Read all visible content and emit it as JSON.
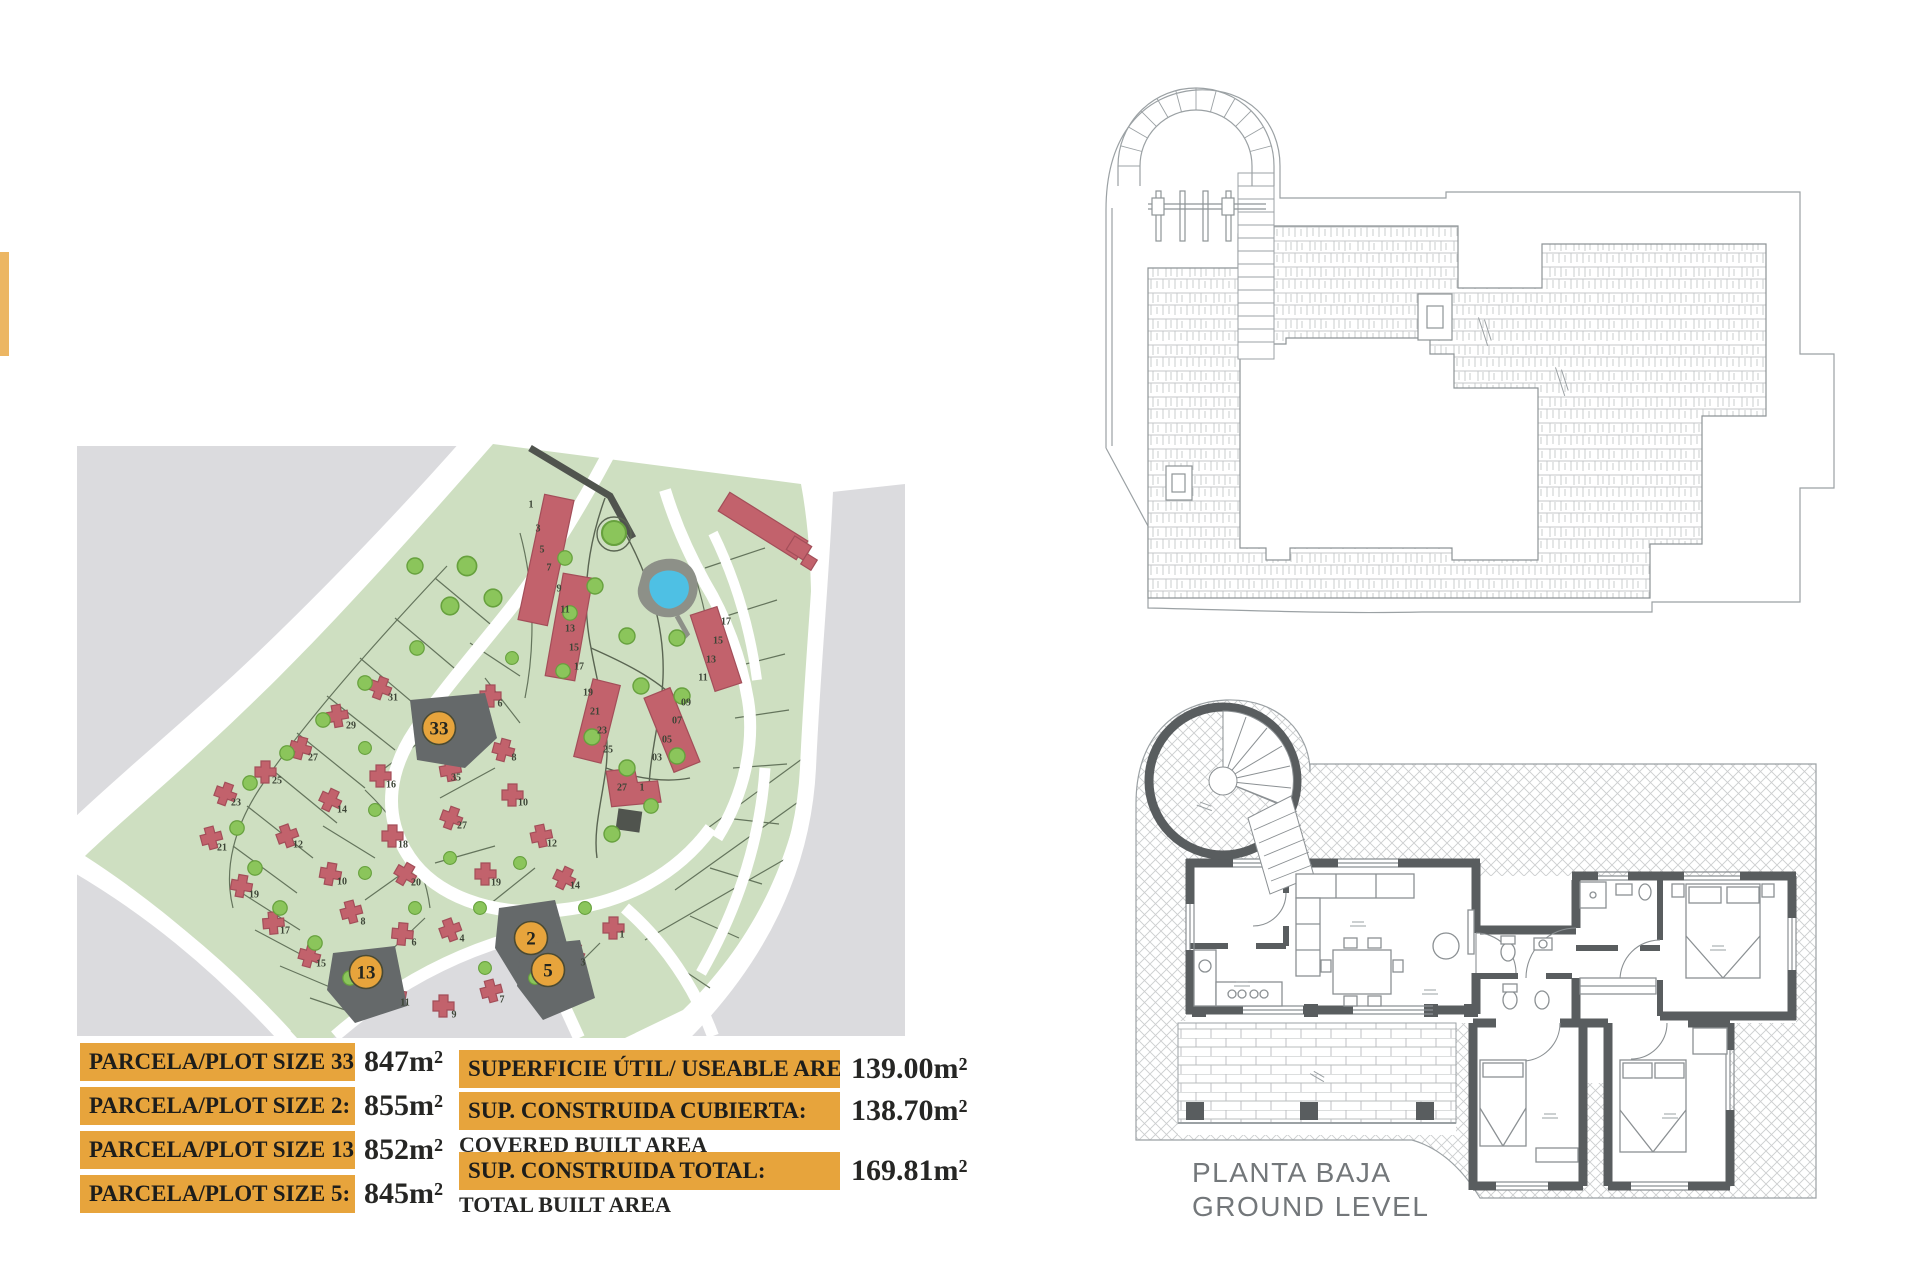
{
  "colors": {
    "accent_orange": "#e7a43c",
    "map_green": "#cedfc1",
    "map_gray": "#dbdbde",
    "building_red": "#c2626c",
    "tree_green": "#8bc55b",
    "pool_blue": "#4ec0e4",
    "highlight_plot_gray": "#65696a",
    "wall_gray": "#595d5f"
  },
  "plot_table": {
    "rows": [
      {
        "label": "PARCELA/PLOT SIZE 33:",
        "value": "847m²"
      },
      {
        "label": "PARCELA/PLOT SIZE 2:",
        "value": "855m²"
      },
      {
        "label": "PARCELA/PLOT SIZE 13:",
        "value": "852m²"
      },
      {
        "label": "PARCELA/PLOT SIZE 5:",
        "value": "845m²"
      }
    ]
  },
  "area_table": {
    "rows": [
      {
        "label": "SUPERFICIE ÚTIL/ USEABLE AREA:",
        "value": "139.00m²",
        "sublabel": ""
      },
      {
        "label": "SUP. CONSTRUIDA CUBIERTA:",
        "value": "138.70m²",
        "sublabel": "COVERED BUILT AREA"
      },
      {
        "label": "SUP. CONSTRUIDA TOTAL:",
        "value": "169.81m²",
        "sublabel": "TOTAL BUILT AREA"
      }
    ]
  },
  "ground_plan": {
    "title_line1": "PLANTA BAJA",
    "title_line2": "GROUND LEVEL"
  },
  "site_plan": {
    "highlights": [
      {
        "n": "33",
        "x": 374,
        "y": 290
      },
      {
        "n": "2",
        "x": 466,
        "y": 500
      },
      {
        "n": "13",
        "x": 301,
        "y": 534
      },
      {
        "n": "5",
        "x": 483,
        "y": 532
      }
    ],
    "plot_numbers": [
      {
        "n": "1",
        "x": 466,
        "y": 66
      },
      {
        "n": "3",
        "x": 473,
        "y": 90
      },
      {
        "n": "5",
        "x": 477,
        "y": 111
      },
      {
        "n": "7",
        "x": 484,
        "y": 129
      },
      {
        "n": "9",
        "x": 494,
        "y": 150
      },
      {
        "n": "11",
        "x": 500,
        "y": 171
      },
      {
        "n": "13",
        "x": 505,
        "y": 190
      },
      {
        "n": "15",
        "x": 509,
        "y": 209
      },
      {
        "n": "17",
        "x": 514,
        "y": 228
      },
      {
        "n": "19",
        "x": 523,
        "y": 254
      },
      {
        "n": "21",
        "x": 530,
        "y": 273
      },
      {
        "n": "23",
        "x": 537,
        "y": 292
      },
      {
        "n": "25",
        "x": 543,
        "y": 311
      },
      {
        "n": "17",
        "x": 661,
        "y": 183
      },
      {
        "n": "15",
        "x": 653,
        "y": 202
      },
      {
        "n": "13",
        "x": 646,
        "y": 221
      },
      {
        "n": "11",
        "x": 638,
        "y": 239
      },
      {
        "n": "09",
        "x": 621,
        "y": 264
      },
      {
        "n": "07",
        "x": 612,
        "y": 282
      },
      {
        "n": "05",
        "x": 602,
        "y": 301
      },
      {
        "n": "03",
        "x": 592,
        "y": 319
      },
      {
        "n": "27",
        "x": 557,
        "y": 349
      },
      {
        "n": "1",
        "x": 577,
        "y": 349
      },
      {
        "n": "31",
        "x": 328,
        "y": 259
      },
      {
        "n": "29",
        "x": 286,
        "y": 287
      },
      {
        "n": "27",
        "x": 248,
        "y": 319
      },
      {
        "n": "25",
        "x": 212,
        "y": 342
      },
      {
        "n": "23",
        "x": 171,
        "y": 364
      },
      {
        "n": "21",
        "x": 157,
        "y": 409
      },
      {
        "n": "19",
        "x": 189,
        "y": 456
      },
      {
        "n": "17",
        "x": 220,
        "y": 492
      },
      {
        "n": "15",
        "x": 256,
        "y": 525
      },
      {
        "n": "16",
        "x": 326,
        "y": 346
      },
      {
        "n": "14",
        "x": 277,
        "y": 371
      },
      {
        "n": "12",
        "x": 233,
        "y": 406
      },
      {
        "n": "10",
        "x": 277,
        "y": 443
      },
      {
        "n": "8",
        "x": 298,
        "y": 483
      },
      {
        "n": "6",
        "x": 349,
        "y": 504
      },
      {
        "n": "6",
        "x": 435,
        "y": 265
      },
      {
        "n": "35",
        "x": 391,
        "y": 339
      },
      {
        "n": "8",
        "x": 449,
        "y": 319
      },
      {
        "n": "18",
        "x": 338,
        "y": 406
      },
      {
        "n": "20",
        "x": 351,
        "y": 444
      },
      {
        "n": "10",
        "x": 458,
        "y": 364
      },
      {
        "n": "27",
        "x": 397,
        "y": 387
      },
      {
        "n": "12",
        "x": 487,
        "y": 405
      },
      {
        "n": "19",
        "x": 431,
        "y": 444
      },
      {
        "n": "14",
        "x": 510,
        "y": 447
      },
      {
        "n": "4",
        "x": 397,
        "y": 500
      },
      {
        "n": "11",
        "x": 340,
        "y": 564
      },
      {
        "n": "9",
        "x": 389,
        "y": 576
      },
      {
        "n": "7",
        "x": 437,
        "y": 561
      },
      {
        "n": "3",
        "x": 518,
        "y": 524
      },
      {
        "n": "1",
        "x": 557,
        "y": 496
      }
    ]
  }
}
